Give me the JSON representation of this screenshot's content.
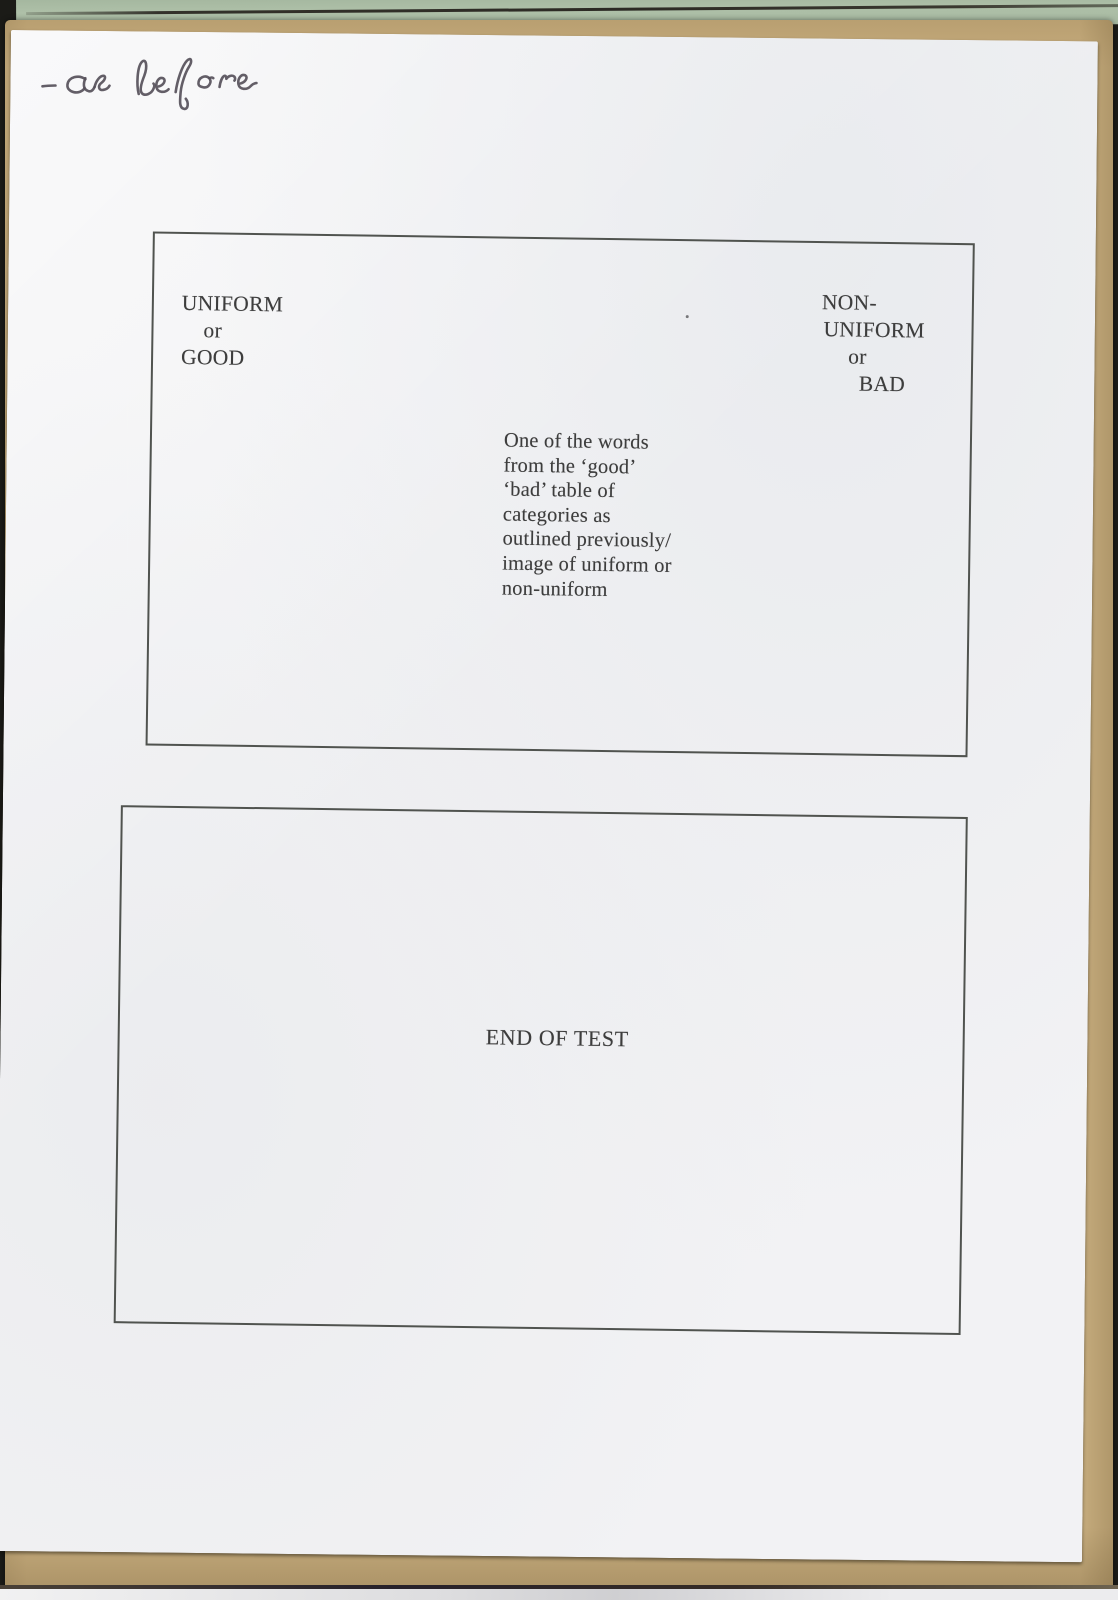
{
  "document": {
    "handwritten_annotation": "-as before",
    "frames": [
      {
        "left_label": {
          "lines": [
            "UNIFORM",
            "or",
            "GOOD"
          ]
        },
        "right_label": {
          "lines": [
            "NON-",
            "UNIFORM",
            "or",
            "BAD"
          ]
        },
        "center_note": {
          "lines": [
            "One of the words",
            "from the ‘good’",
            "‘bad’ table of",
            "categories as",
            "outlined previously/",
            "image of uniform or",
            "non-uniform"
          ]
        }
      },
      {
        "center_label": "END OF TEST"
      }
    ]
  },
  "colors": {
    "paper": "#f2f2f4",
    "kraft_backing": "#c7ad7e",
    "green_sheet": "#aec0a8",
    "ink": "#3d3d3d",
    "pen_ink": "#56505a",
    "frame_border": "#50534f"
  }
}
